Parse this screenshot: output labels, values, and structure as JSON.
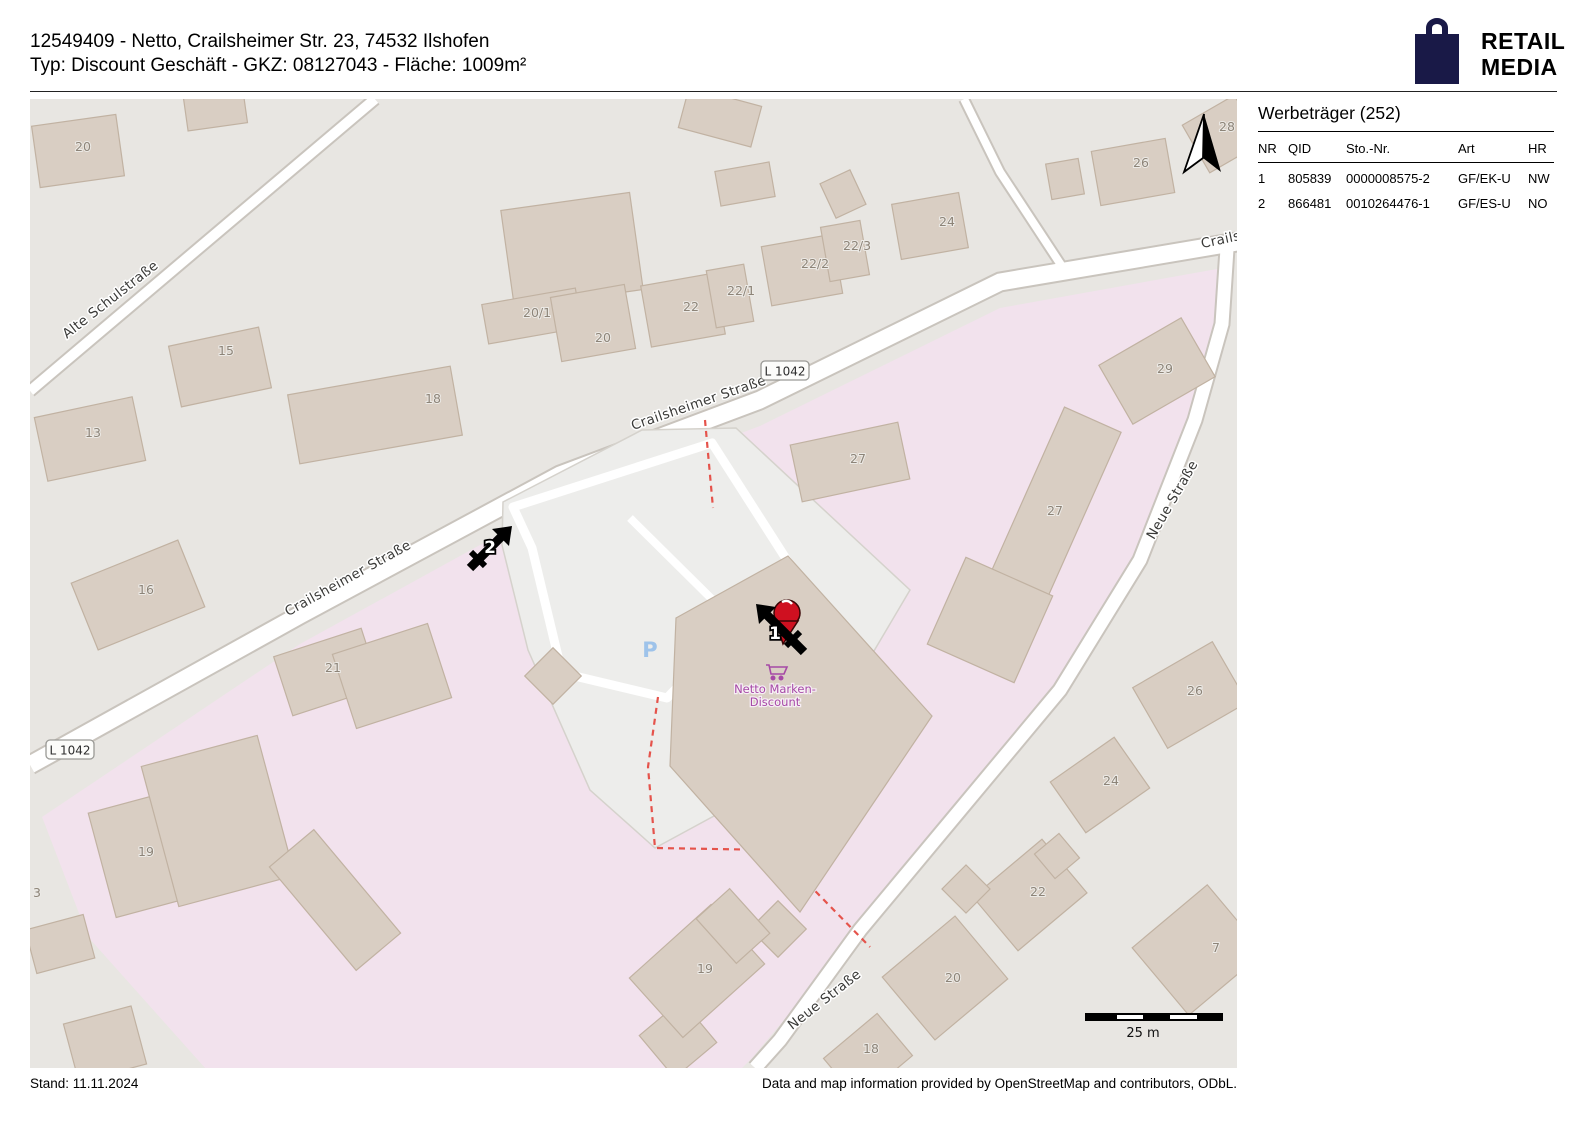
{
  "header": {
    "line1": "12549409 - Netto, Crailsheimer Str. 23, 74532 Ilshofen",
    "line2": "Typ: Discount Geschäft - GKZ: 08127043 - Fläche: 1009m²"
  },
  "logo": {
    "line1": "RETAIL",
    "line2": "MEDIA",
    "color": "#191947"
  },
  "sidebar": {
    "title": "Werbeträger (252)",
    "columns": [
      "NR",
      "QID",
      "Sto.-Nr.",
      "Art",
      "HR"
    ],
    "rows": [
      [
        "1",
        "805839",
        "0000008575-2",
        "GF/EK-U",
        "NW"
      ],
      [
        "2",
        "866481",
        "0010264476-1",
        "GF/ES-U",
        "NO"
      ]
    ]
  },
  "footer": {
    "left": "Stand: 11.11.2024",
    "right": "Data and map information provided by OpenStreetMap and contributors, ODbL."
  },
  "map": {
    "colors": {
      "base": "#e8e6e2",
      "residential_pink": "#f2e2ed",
      "building": "#d9cec3",
      "building_stroke": "#c1b2a2",
      "road_fill": "#ffffff",
      "road_casing": "#c9c4bd",
      "site_gray": "#ededeb",
      "boundary_red": "#e5534b",
      "parking_blue": "#9ec3ea",
      "poi_purple": "#a649a6",
      "logo_navy": "#191947"
    },
    "street_labels": [
      {
        "t": "Alte Schulstraße",
        "x": 83,
        "y": 204,
        "r": -38
      },
      {
        "t": "Crailsheimer Straße",
        "x": 320,
        "y": 483,
        "r": -29
      },
      {
        "t": "Crailsheimer Straße",
        "x": 670,
        "y": 308,
        "r": -19
      },
      {
        "t": "Crailsh",
        "x": 1196,
        "y": 144,
        "r": -12
      },
      {
        "t": "Neue Straße",
        "x": 1146,
        "y": 403,
        "r": -60
      },
      {
        "t": "Neue Straße",
        "x": 797,
        "y": 904,
        "r": -38
      }
    ],
    "route_badges": [
      {
        "t": "L 1042",
        "x": 40,
        "y": 651
      },
      {
        "t": "L 1042",
        "x": 755,
        "y": 272
      }
    ],
    "building_numbers": [
      {
        "t": "20",
        "x": 45,
        "y": 52
      },
      {
        "t": "15",
        "x": 188,
        "y": 256
      },
      {
        "t": "13",
        "x": 55,
        "y": 338
      },
      {
        "t": "18",
        "x": 395,
        "y": 304
      },
      {
        "t": "16",
        "x": 108,
        "y": 495
      },
      {
        "t": "21",
        "x": 295,
        "y": 573
      },
      {
        "t": "19",
        "x": 108,
        "y": 757
      },
      {
        "t": "3",
        "x": 3,
        "y": 798
      },
      {
        "t": "20/1",
        "x": 493,
        "y": 218
      },
      {
        "t": "20",
        "x": 565,
        "y": 243
      },
      {
        "t": "22",
        "x": 653,
        "y": 212
      },
      {
        "t": "22/1",
        "x": 697,
        "y": 196
      },
      {
        "t": "22/2",
        "x": 771,
        "y": 169
      },
      {
        "t": "22/3",
        "x": 813,
        "y": 151
      },
      {
        "t": "24",
        "x": 909,
        "y": 127
      },
      {
        "t": "26",
        "x": 1103,
        "y": 68
      },
      {
        "t": "28",
        "x": 1189,
        "y": 32
      },
      {
        "t": "29",
        "x": 1127,
        "y": 274
      },
      {
        "t": "27",
        "x": 820,
        "y": 364
      },
      {
        "t": "27",
        "x": 1017,
        "y": 416
      },
      {
        "t": "26",
        "x": 1157,
        "y": 596
      },
      {
        "t": "24",
        "x": 1073,
        "y": 686
      },
      {
        "t": "22",
        "x": 1000,
        "y": 797
      },
      {
        "t": "7",
        "x": 1182,
        "y": 853
      },
      {
        "t": "20",
        "x": 915,
        "y": 883
      },
      {
        "t": "19",
        "x": 667,
        "y": 874
      },
      {
        "t": "18",
        "x": 833,
        "y": 954
      }
    ],
    "markers": [
      {
        "nr": "1",
        "x": 745,
        "y": 534
      },
      {
        "nr": "2",
        "x": 460,
        "y": 447
      }
    ],
    "poi": {
      "line1": "Netto Marken-",
      "line2": "Discount"
    },
    "parking": {
      "symbol": "P"
    },
    "scale_bar": {
      "label": "25 m"
    }
  }
}
